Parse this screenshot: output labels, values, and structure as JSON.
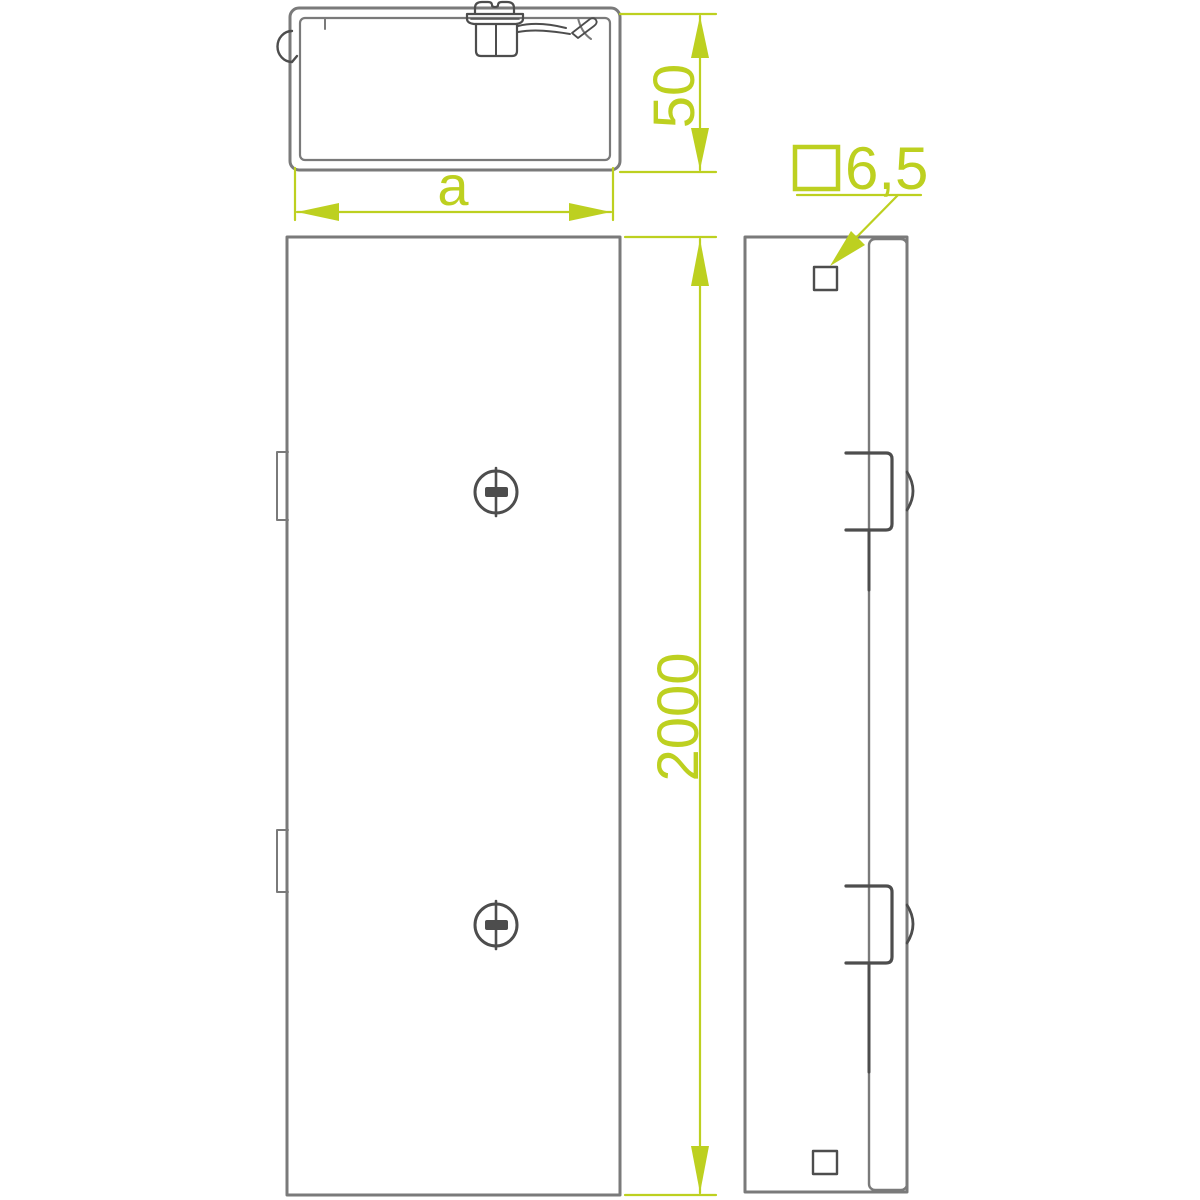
{
  "drawing": {
    "kind": "technical-drawing-cable-trunking-cover",
    "background": "#ffffff",
    "colors": {
      "dimension_accent": "#bdd020",
      "outline_gray": "#7a7a7a",
      "detail_dark": "#4d4d4d"
    },
    "cross_section_view": {
      "height_label": "50",
      "width_label": "a"
    },
    "front_view": {
      "length_label": "2000"
    },
    "side_view": {
      "hole_size_label": "6,5",
      "hole_symbol": "square"
    }
  }
}
